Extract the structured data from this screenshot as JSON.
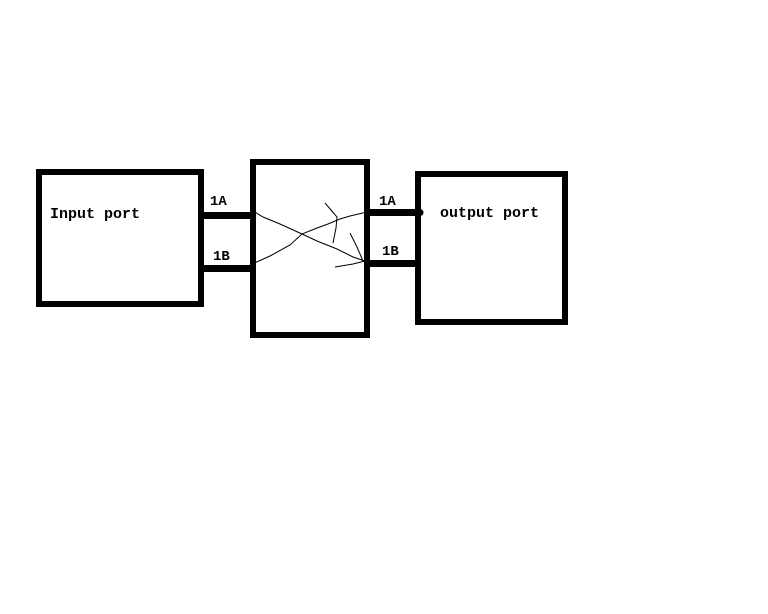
{
  "diagram": {
    "input_box": {
      "label": "Input port"
    },
    "output_box": {
      "label": "output port"
    },
    "left_connectors": {
      "top": "1A",
      "bottom": "1B"
    },
    "right_connectors": {
      "top": "1A",
      "bottom": "1B"
    },
    "colors": {
      "ink": "#000000",
      "background": "#ffffff"
    }
  }
}
